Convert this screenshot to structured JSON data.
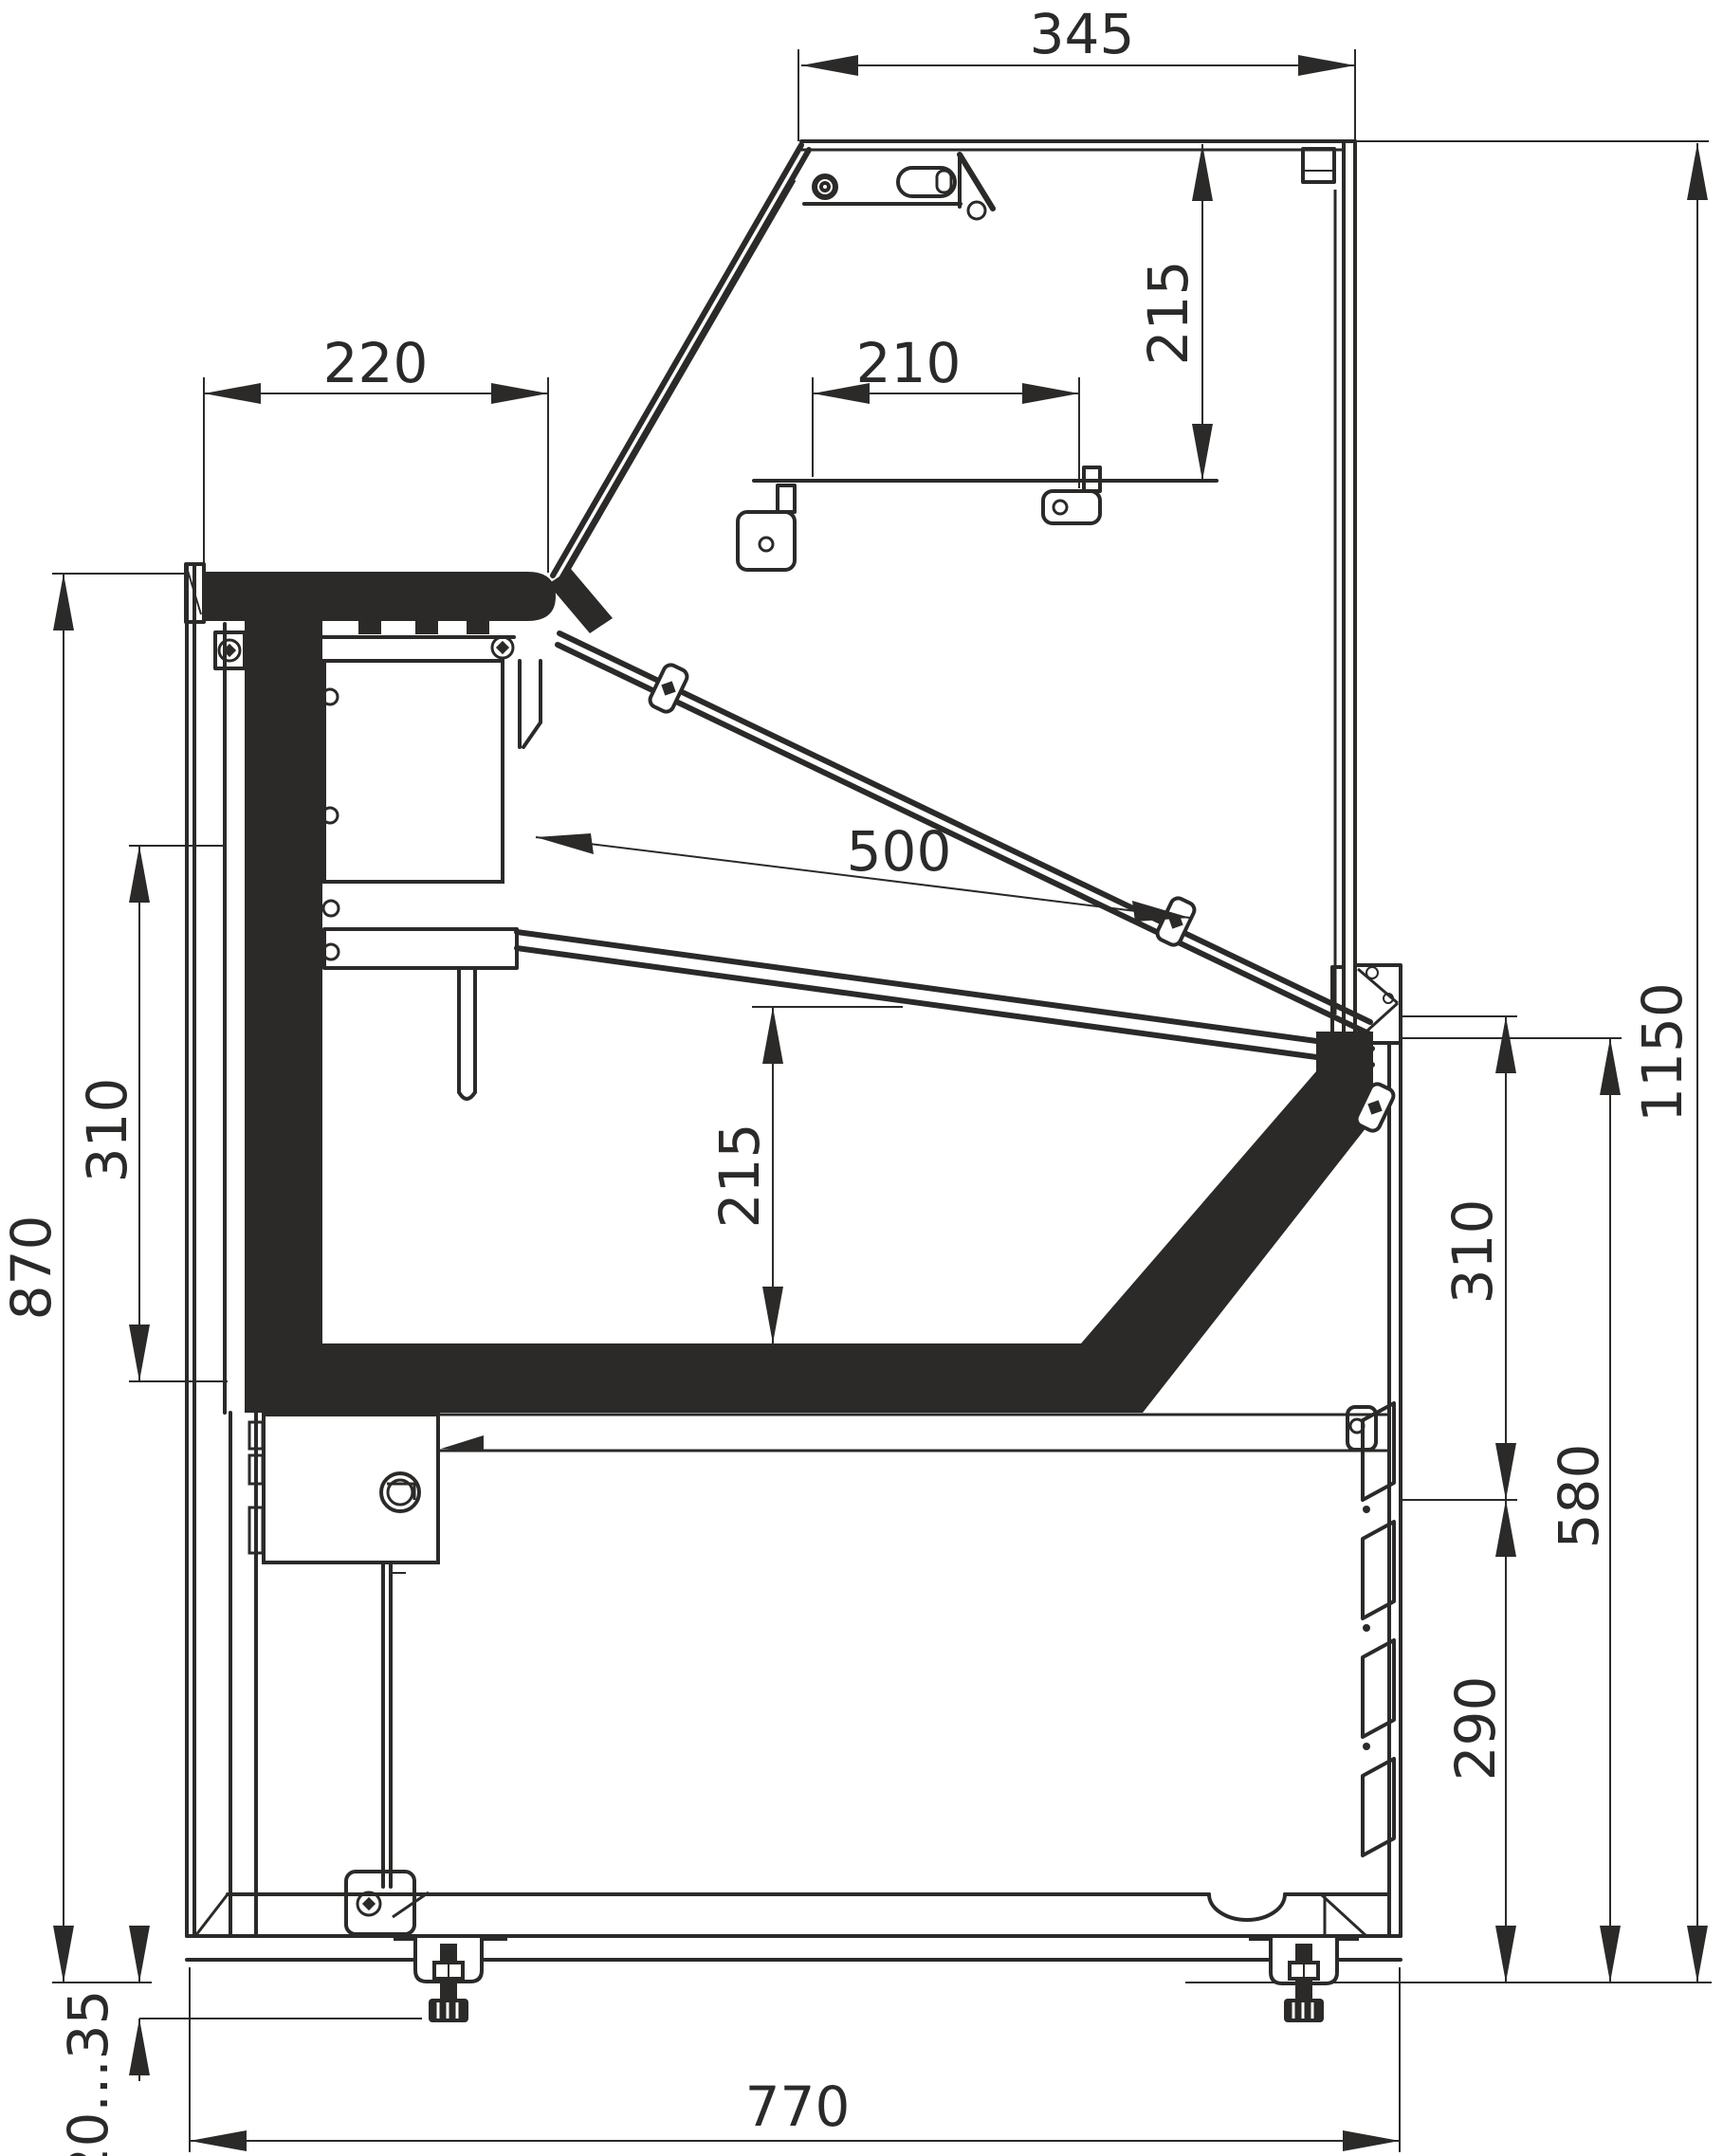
{
  "drawing": {
    "type": "technical-section",
    "subject": "refrigerated serve-over display counter, side cross-section",
    "units": "mm"
  },
  "dims": {
    "top_overhang": "345",
    "canopy_to_shelf": "215",
    "worktop_depth": "220",
    "shelf_depth": "210",
    "glass_length": "500",
    "side_panel_height": "310",
    "worktop_height": "870",
    "well_height": "215",
    "overall_height": "1150",
    "right_upper": "310",
    "service_height": "580",
    "louver_panel": "290",
    "base_depth": "770",
    "foot_adjust": "20...35"
  },
  "colors": {
    "ink": "#2b2a29",
    "background": "#ffffff"
  }
}
